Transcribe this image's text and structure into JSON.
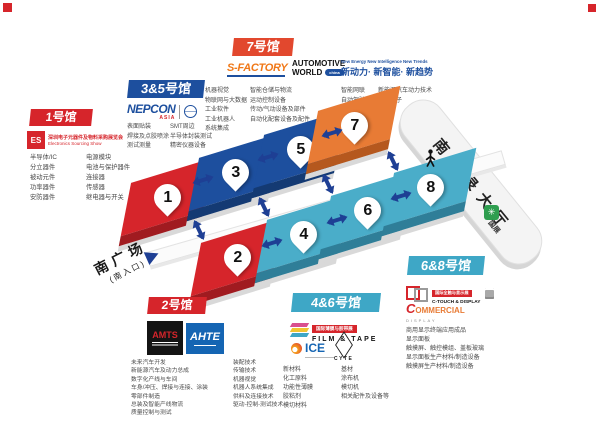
{
  "colors": {
    "red": "#d6252b",
    "dark_blue": "#1d4f9e",
    "orange_badge": "#e2482e",
    "orange_block": "#e87b35",
    "teal": "#3ea7c6",
    "arrow_blue": "#1e3f94",
    "block_base_gray": "#d9d9d9"
  },
  "halls": {
    "hall1": {
      "badge": "1号馆",
      "logo": {
        "mark": "ES",
        "cn": "深圳电子元器件及物料采购展览会",
        "en": "Electronics Sourcing Show"
      },
      "col1": [
        "半导体/IC",
        "分立器件",
        "被动元件",
        "功率器件",
        "安防器件"
      ],
      "col2": [
        "电源模块",
        "电池与保护器件",
        "连接器",
        "传感器",
        "继电器与开关"
      ]
    },
    "hall35": {
      "badge": "3&5号馆",
      "logo": {
        "name": "NEPCON",
        "sub": "ASIA"
      },
      "col1": [
        "表面贴装",
        "焊接及点胶喷涂",
        "测试测量"
      ],
      "col2": [
        "SMT周边",
        "半导体封装测试",
        "精密仪器设备"
      ]
    },
    "hall7": {
      "badge": "7号馆",
      "logo_sfactory": "S-FACTORY",
      "logo_automotive": {
        "line1": "AUTOMOTIVE",
        "line2": "WORLD",
        "oval": "china",
        "en": "New Energy New Intelligence New Trends",
        "cn": "新动力· 新智能· 新趋势"
      },
      "col1": [
        "机器视觉",
        "物联网与大数据",
        "工业软件",
        "工业机器人",
        "系统集成"
      ],
      "col2": [
        "智能仓储与物流",
        "运动控制设备",
        "传动/气动设备及部件",
        "自动化配套设备及配件"
      ],
      "col3": [
        "智能网联",
        "自动驾驶",
        "智慧座舱"
      ],
      "col4": [
        "新能源汽车动力技术",
        "汽车电子"
      ]
    },
    "hall2": {
      "badge": "2号馆",
      "logo_amts": "AMTS",
      "logo_ahte": "AHTE",
      "col1": [
        "未来汽车开发",
        "新能源汽车及动力总成",
        "数字化产线与车间",
        "车身/冲压、焊接与连接、涂装",
        "零部件制造",
        "总装及智能产线物流",
        "质量控制与测试"
      ],
      "col2": [
        "装配技术",
        "传输技术",
        "机器视觉",
        "机器人系统集成",
        "供料及连接技术",
        "驱动-控制-测试技术"
      ]
    },
    "hall46": {
      "badge": "4&6号馆",
      "logo_film": {
        "bar": "国际薄膜与胶带展",
        "name": "FILM & TAPE"
      },
      "logo_ice": "ICE",
      "logo_cyte": "CYTE",
      "col1": [
        "新材料",
        "化工原料",
        "功能性薄膜",
        "胶粘剂",
        "模切材料"
      ],
      "col2": [
        "基材",
        "涂布机",
        "模切机",
        "相关配件及设备等"
      ]
    },
    "hall68": {
      "badge": "6&8号馆",
      "logo_ctouch": {
        "bar": "国际全触与显示展",
        "name": "C-TOUCH & DISPLAY"
      },
      "logo_commercial": {
        "c": "C",
        "rest": "OMMERCIAL",
        "sub": "DISPLAY"
      },
      "items": [
        "商用显示终端应用成品",
        "显示面板",
        "触摸屏、触控模组、盖板玻璃",
        "显示面板生产材料/制造设备",
        "触摸屏生产材料/制造设备"
      ]
    }
  },
  "blocks": [
    {
      "num": "1"
    },
    {
      "num": "2"
    },
    {
      "num": "3"
    },
    {
      "num": "4"
    },
    {
      "num": "5"
    },
    {
      "num": "6"
    },
    {
      "num": "7"
    },
    {
      "num": "8"
    }
  ],
  "banner": {
    "label": "南登录大厅"
  },
  "entrance": {
    "line1": "南广场",
    "line2": "(南入口)"
  },
  "guozhan": {
    "label": "国展"
  }
}
